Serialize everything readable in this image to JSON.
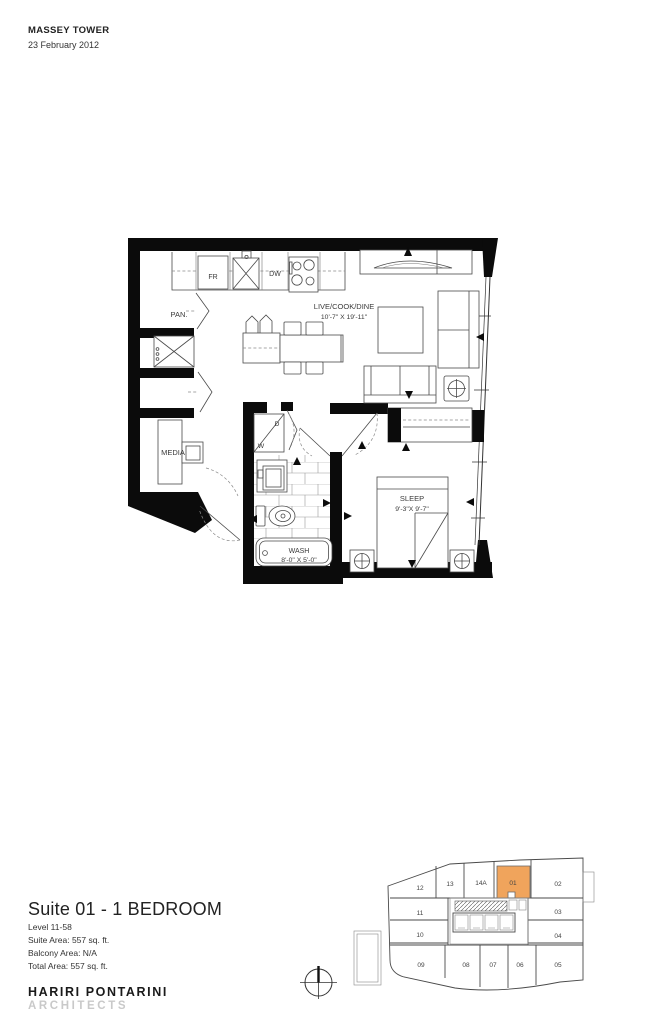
{
  "header": {
    "project": "MASSEY TOWER",
    "date": "23 February 2012"
  },
  "info": {
    "title": "Suite 01 - 1 BEDROOM",
    "level": "Level 11-58",
    "suite_area": "Suite Area: 557 sq. ft.",
    "balcony_area": "Balcony Area: N/A",
    "total_area": "Total Area: 557 sq. ft.",
    "firm": "HARIRI PONTARINI",
    "firm_dept": "ARCHITECTS"
  },
  "plan": {
    "labels": {
      "fridge": "FR",
      "dishwasher": "DW",
      "pantry": "PAN.",
      "media": "MEDIA",
      "living": "LIVE/COOK/DINE",
      "living_dims": "10'-7\" X 19'-11\"",
      "sleep": "SLEEP",
      "sleep_dims": "9'-3\"X 9'-7\"",
      "wash": "WASH",
      "wash_dims": "8'-0\" X 5'-0\"",
      "washer": "W",
      "dryer": "D"
    }
  },
  "keyplan": {
    "highlighted_unit": "01",
    "highlight_color": "#F0A45C",
    "units": [
      "12",
      "13",
      "14A",
      "01",
      "02",
      "11",
      "03",
      "10",
      "04",
      "09",
      "08",
      "07",
      "06",
      "05"
    ]
  }
}
